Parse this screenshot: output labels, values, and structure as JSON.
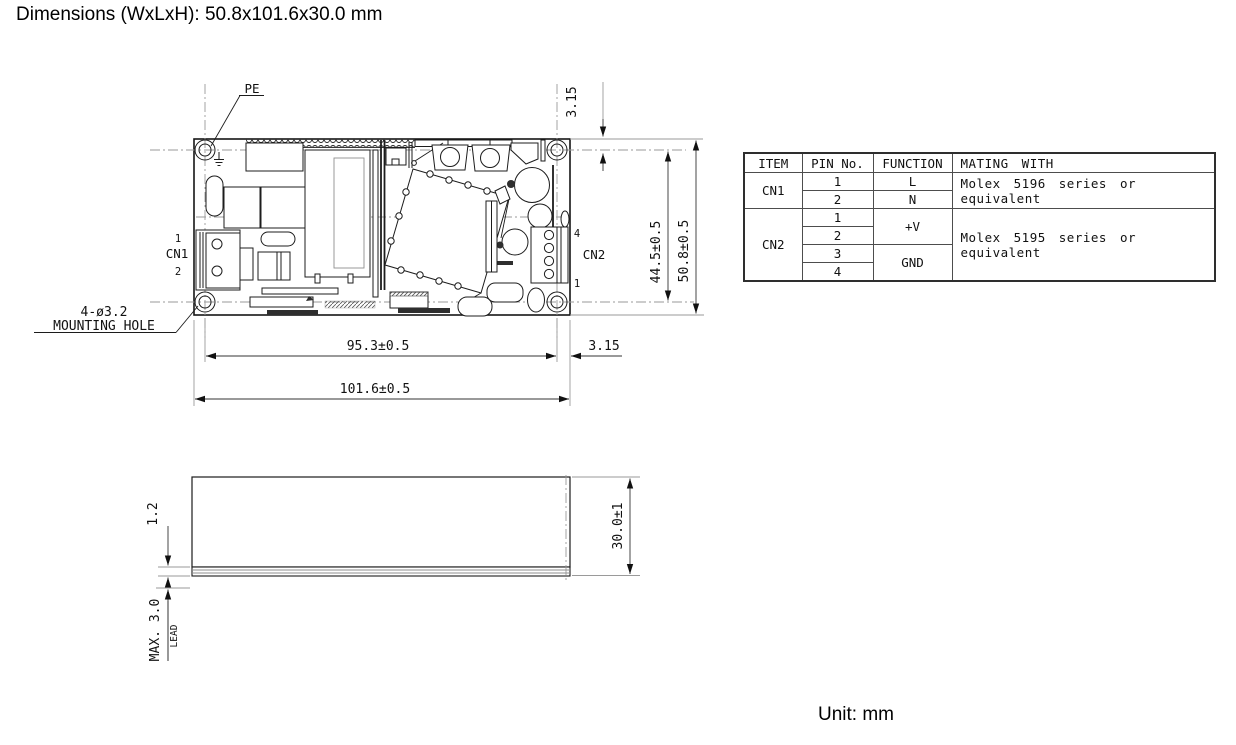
{
  "title": "Dimensions (WxLxH): 50.8x101.6x30.0 mm",
  "unit_note": "Unit: mm",
  "drawing": {
    "pe_label": "PE",
    "mounting_hole_label": {
      "line1": "4-ø3.2",
      "line2": "MOUNTING HOLE"
    },
    "cn1": {
      "label": "CN1",
      "pin_top": "1",
      "pin_bottom": "2"
    },
    "cn2": {
      "label": "CN2",
      "pin_top": "4",
      "pin_bottom": "1"
    },
    "dimensions": {
      "top_edge_to_hole": "3.15",
      "hole_to_hole_vertical": "44.5±0.5",
      "board_width": "50.8±0.5",
      "hole_to_hole_horizontal": "95.3±0.5",
      "hole_to_edge_right": "3.15",
      "board_length": "101.6±0.5",
      "pcb_thickness": "1.2",
      "case_height": "30.0±1",
      "lead_max": "MAX. 3.0",
      "lead_label": "LEAD"
    }
  },
  "connector_table": {
    "headers": {
      "item": "ITEM",
      "pin": "PIN No.",
      "function": "FUNCTION",
      "mating": "MATING WITH"
    },
    "cn1": {
      "item": "CN1",
      "pin1": "1",
      "pin2": "2",
      "fn1": "L",
      "fn2": "N",
      "mating": "Molex 5196 series or equivalent"
    },
    "cn2": {
      "item": "CN2",
      "pin1": "1",
      "pin2": "2",
      "pin3": "3",
      "pin4": "4",
      "fn12": "+V",
      "fn34": "GND",
      "mating": "Molex 5195 series or equivalent"
    }
  }
}
